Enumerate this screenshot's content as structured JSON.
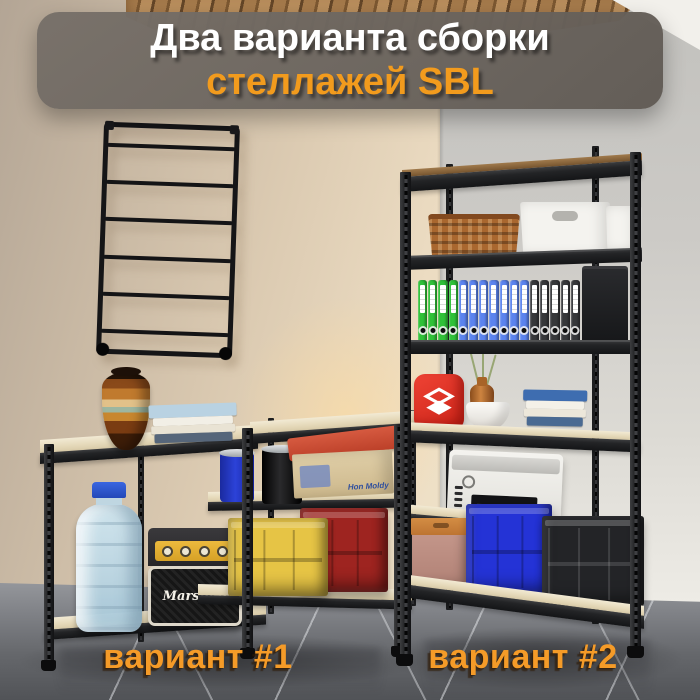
{
  "banner": {
    "line1": "Два варианта сборки",
    "line2": "стеллажей SBL"
  },
  "labels": {
    "variant1": "вариант #1",
    "variant2": "вариант #2"
  },
  "branding": {
    "amp_logo": "Marshall",
    "shoebox_text": "Hon Moldy"
  },
  "wall_ladder": {
    "inner_rungs": 6
  },
  "rack1": {
    "items": [
      "striped-ceramic-vase",
      "book-stack",
      "19l-water-bottle",
      "marshall-amp",
      "blue-paint-can",
      "black-paint-can",
      "cardboard-shoebox",
      "yellow-crate",
      "red-crate"
    ]
  },
  "rack2": {
    "binder_groups": [
      {
        "color": "#2fc138",
        "count": 4
      },
      {
        "color": "#5b83ee",
        "count": 7
      },
      {
        "color": "#37383b",
        "count": 5
      }
    ],
    "items": [
      "wicker-basket",
      "white-storage-box",
      "white-storage-box-2",
      "black-box",
      "red-logo-box",
      "decor-vases",
      "book-stack",
      "printer",
      "tan-storage-box",
      "blue-crate",
      "black-crate"
    ]
  },
  "palette": {
    "accent_orange": "#f29b1d",
    "label_orange": "#f59b28",
    "banner_bg": "#6e6862",
    "rack_metal": "#232426",
    "shelf_wood": "#e9dfc4",
    "wall_left": "#e2d2ba",
    "wall_back": "#cfcdc9",
    "floor_gray": "#6f7175"
  }
}
